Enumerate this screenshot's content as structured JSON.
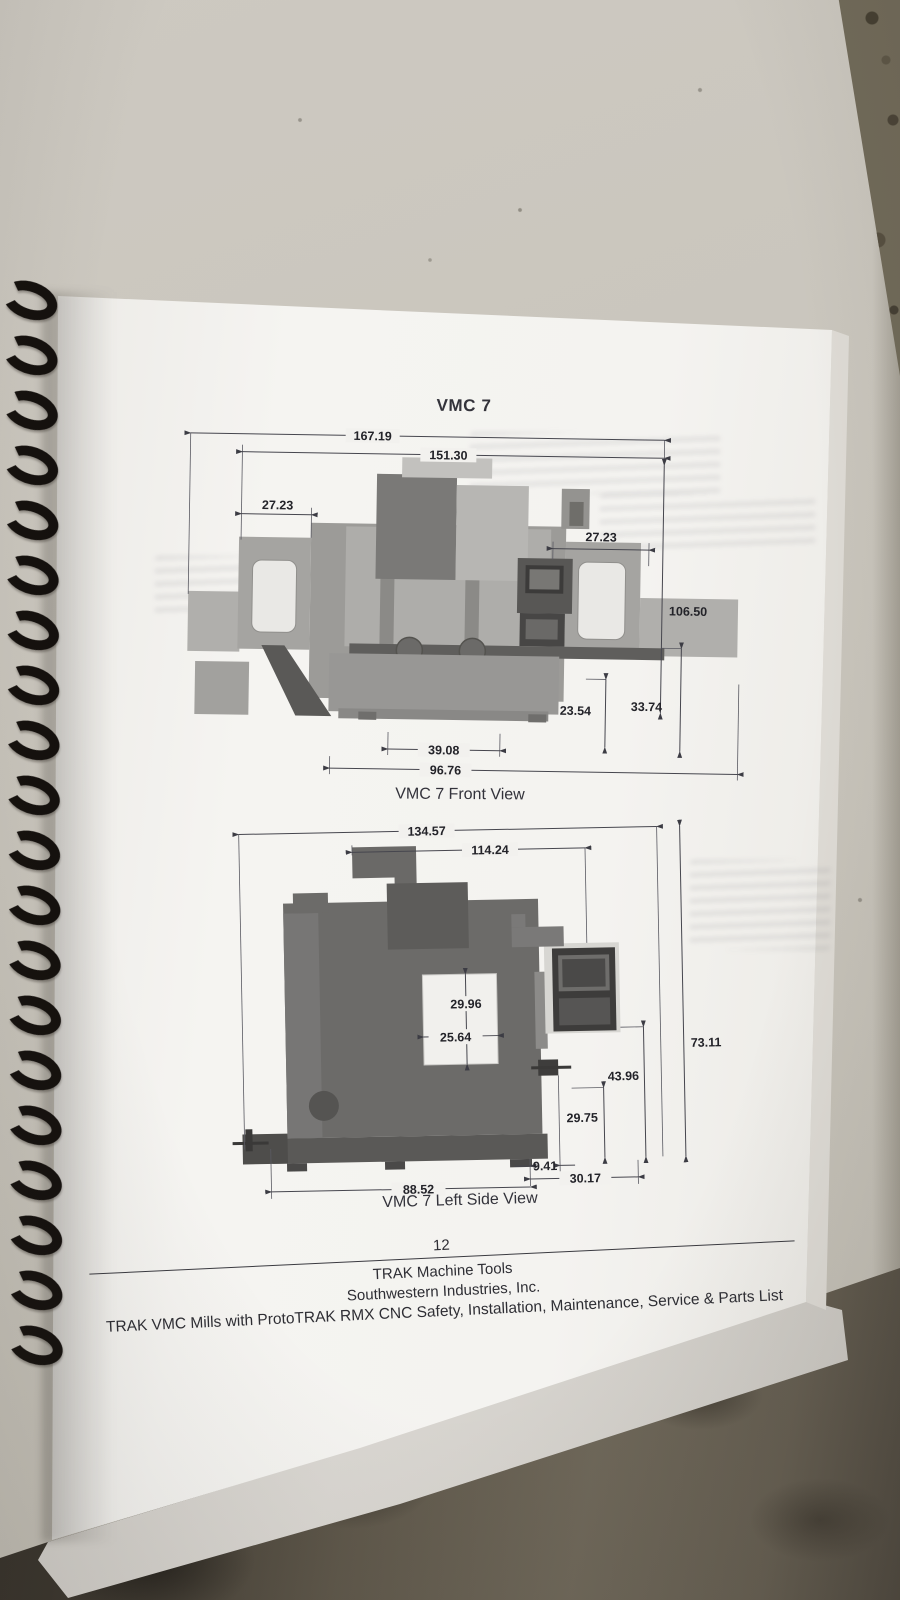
{
  "document": {
    "title": "VMC 7",
    "page_number": "12",
    "footer": {
      "company": "TRAK Machine Tools",
      "subsidiary": "Southwestern Industries, Inc.",
      "manual_title": "TRAK VMC Mills with ProtoTRAK RMX CNC Safety, Installation, Maintenance, Service & Parts List"
    },
    "figures": {
      "front": {
        "caption": "VMC 7 Front View",
        "dims": {
          "overall_width": "167.19",
          "enclosure_width": "151.30",
          "left_door_width": "27.23",
          "right_door_width": "27.23",
          "overall_height": "106.50",
          "table_height": "33.74",
          "window_height": "23.54",
          "table_width": "39.08",
          "base_width": "96.76"
        }
      },
      "side": {
        "caption": "VMC 7 Left Side View",
        "dims": {
          "overall_depth": "134.57",
          "enclosure_depth": "114.24",
          "window_height": "29.96",
          "window_width": "25.64",
          "overall_height": "73.11",
          "pendant_height": "43.96",
          "lower_height": "29.75",
          "foot_depth": "9.41",
          "rear_depth": "30.17",
          "base_depth": "88.52"
        }
      }
    }
  }
}
